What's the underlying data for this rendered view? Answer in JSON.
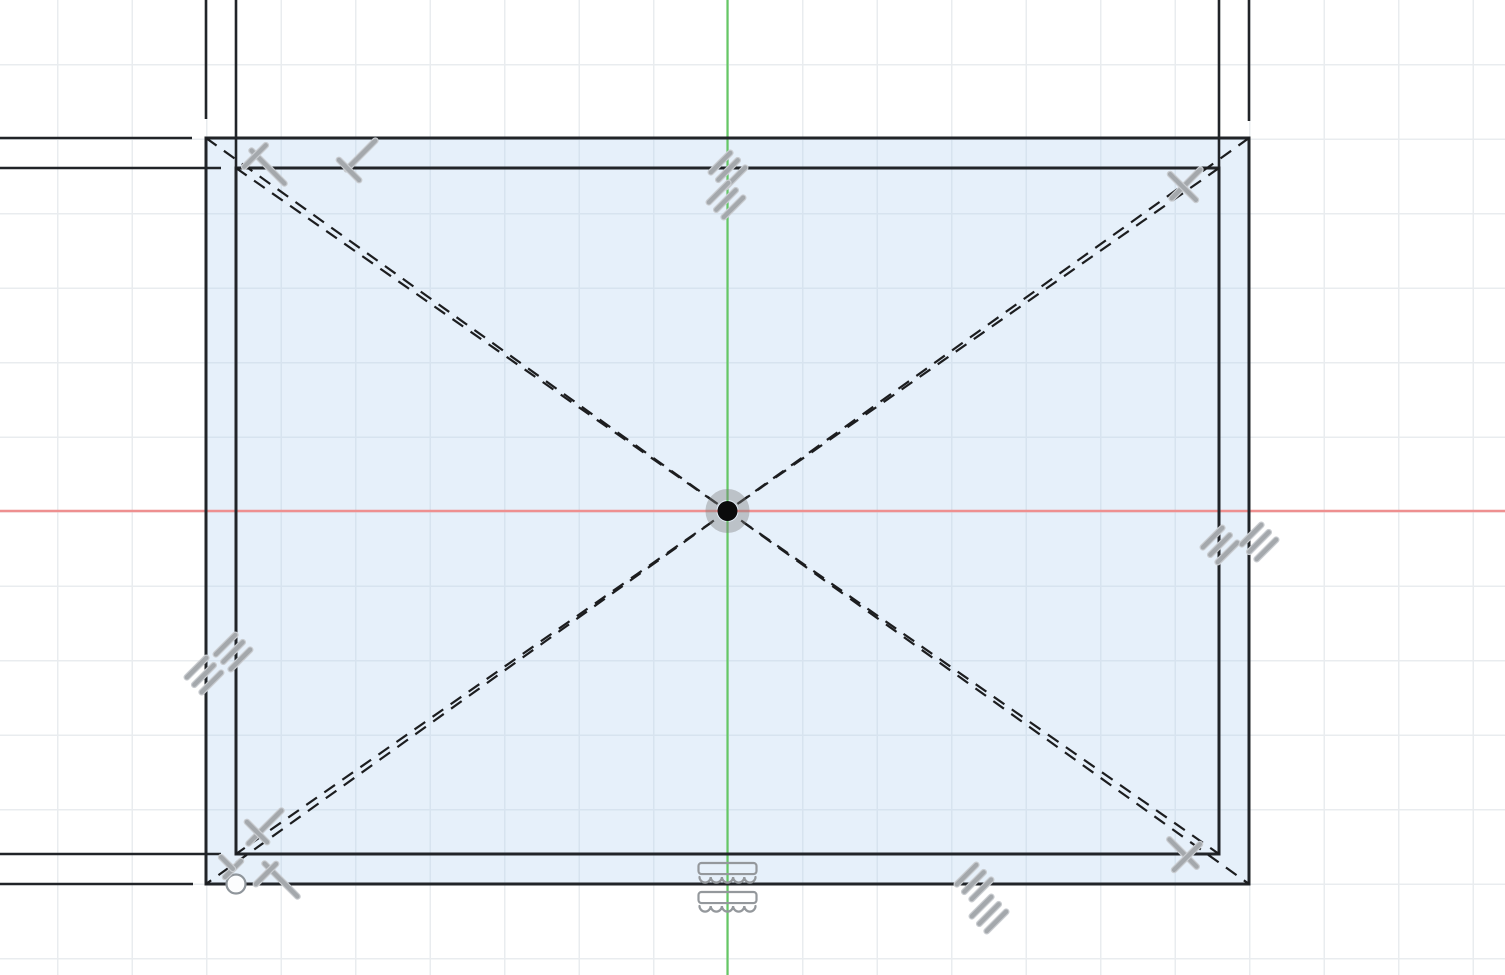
{
  "canvas": {
    "width": 1505,
    "height": 975,
    "background": "#ffffff",
    "grid": {
      "spacing": 74.5,
      "offset_x": 57,
      "offset_y": 64,
      "color": "#e9ecef"
    }
  },
  "style": {
    "wall_line_color": "#212428",
    "wall_line_width": 3,
    "extension_line_width": 2.6,
    "construction_color": "#1c1d1f",
    "construction_dash": "13 9",
    "construction_width": 2.2,
    "axis_green": "#65c765",
    "axis_red": "#ee9090",
    "profile_fill": "rgba(182,212,240,0.35)",
    "glyph_bar_fill": "#a4a8ac",
    "glyph_bar_stroke": "#c9ccd0",
    "glyph_outline_stroke": "#94989c",
    "hatch_bar_length": 33,
    "hatch_bar_width": 5.5,
    "hatch_bar_gap": 10.5,
    "perp_bar_width": 5.5,
    "fix_glyph_width": 58,
    "fix_glyph_height": 24
  },
  "entities": [
    {
      "name": "profile-fill",
      "type": "rect",
      "x": 206,
      "y": 138,
      "w": 1043,
      "h": 746,
      "fill": "rgba(182,212,240,0.35)",
      "stroke": "none",
      "sw": 0,
      "interactable": true
    },
    {
      "name": "y-axis-line",
      "type": "line",
      "x1": 727.5,
      "y1": 0,
      "x2": 727.5,
      "y2": 975,
      "stroke": "#65c765",
      "sw": 2.2,
      "interactable": true
    },
    {
      "name": "x-axis-line",
      "type": "line",
      "x1": 0,
      "y1": 511,
      "x2": 1505,
      "y2": 511,
      "stroke": "#ee9090",
      "sw": 2.4,
      "interactable": true
    },
    {
      "name": "wall-extension-line-top-outer-left",
      "type": "line",
      "x1": 0,
      "y1": 138,
      "x2": 192,
      "y2": 138,
      "stroke": "#212428",
      "sw": 2.6,
      "interactable": true
    },
    {
      "name": "wall-extension-line-top-inner-left",
      "type": "line",
      "x1": 0,
      "y1": 168,
      "x2": 221,
      "y2": 168,
      "stroke": "#212428",
      "sw": 2.6,
      "interactable": true
    },
    {
      "name": "wall-extension-line-bottom-inner-left",
      "type": "line",
      "x1": 0,
      "y1": 854,
      "x2": 221,
      "y2": 854,
      "stroke": "#212428",
      "sw": 2.6,
      "interactable": true
    },
    {
      "name": "wall-extension-line-bottom-outer-left",
      "type": "line",
      "x1": 0,
      "y1": 884,
      "x2": 193,
      "y2": 884,
      "stroke": "#212428",
      "sw": 2.6,
      "interactable": true
    },
    {
      "name": "wall-extension-line-left-outer-top",
      "type": "line",
      "x1": 206,
      "y1": 0,
      "x2": 206,
      "y2": 119,
      "stroke": "#212428",
      "sw": 2.6,
      "interactable": true
    },
    {
      "name": "wall-extension-line-left-inner-top",
      "type": "line",
      "x1": 236,
      "y1": 0,
      "x2": 236,
      "y2": 168,
      "stroke": "#212428",
      "sw": 2.6,
      "interactable": true
    },
    {
      "name": "wall-extension-line-right-inner-top",
      "type": "line",
      "x1": 1219,
      "y1": 0,
      "x2": 1219,
      "y2": 168,
      "stroke": "#212428",
      "sw": 2.6,
      "interactable": true
    },
    {
      "name": "wall-extension-line-right-outer-top",
      "type": "line",
      "x1": 1249,
      "y1": 0,
      "x2": 1249,
      "y2": 121,
      "stroke": "#212428",
      "sw": 2.6,
      "interactable": true
    },
    {
      "name": "outer-wall-rectangle",
      "type": "rect",
      "x": 206,
      "y": 138,
      "w": 1043,
      "h": 746,
      "fill": "none",
      "stroke": "#212428",
      "sw": 3,
      "interactable": true
    },
    {
      "name": "inner-wall-rectangle",
      "type": "rect",
      "x": 236,
      "y": 168,
      "w": 983,
      "h": 686,
      "fill": "none",
      "stroke": "#212428",
      "sw": 3,
      "interactable": true
    },
    {
      "name": "construction-diagonal-outer-tlbr",
      "type": "line",
      "x1": 206,
      "y1": 138,
      "x2": 1249,
      "y2": 884,
      "stroke": "#1c1d1f",
      "sw": 2.2,
      "dash": "13 9",
      "interactable": true
    },
    {
      "name": "construction-diagonal-outer-trbl",
      "type": "line",
      "x1": 1249,
      "y1": 138,
      "x2": 206,
      "y2": 884,
      "stroke": "#1c1d1f",
      "sw": 2.2,
      "dash": "13 9",
      "interactable": true
    },
    {
      "name": "construction-diagonal-inner-tlbr",
      "type": "line",
      "x1": 236,
      "y1": 168,
      "x2": 1219,
      "y2": 854,
      "stroke": "#1c1d1f",
      "sw": 2.2,
      "dash": "13 9",
      "interactable": true
    },
    {
      "name": "construction-diagonal-inner-trbl",
      "type": "line",
      "x1": 1219,
      "y1": 168,
      "x2": 236,
      "y2": 854,
      "stroke": "#1c1d1f",
      "sw": 2.2,
      "dash": "13 9",
      "interactable": true
    },
    {
      "name": "origin-highlight-ring",
      "type": "circle",
      "cx": 727.5,
      "cy": 511,
      "r": 16.5,
      "fill": "none",
      "stroke": "rgba(125,125,125,0.4)",
      "sw": 11,
      "interactable": false
    },
    {
      "name": "origin-point",
      "type": "circle",
      "cx": 727.5,
      "cy": 511,
      "r": 10,
      "fill": "#0b0b0c",
      "stroke": "none",
      "sw": 0,
      "interactable": true
    },
    {
      "name": "sketch-endpoint",
      "type": "circle",
      "cx": 236,
      "cy": 884,
      "r": 9.5,
      "fill": "#fcfdfe",
      "stroke": "#8f959b",
      "sw": 2.2,
      "interactable": true
    },
    {
      "name": "parallel-constraint-icon",
      "type": "hatch",
      "cx": 728,
      "cy": 170,
      "interactable": true
    },
    {
      "name": "parallel-constraint-icon",
      "type": "hatch",
      "cx": 726,
      "cy": 200,
      "interactable": true
    },
    {
      "name": "parallel-constraint-icon",
      "type": "hatch",
      "cx": 1220,
      "cy": 545,
      "interactable": true
    },
    {
      "name": "parallel-constraint-icon",
      "type": "hatch",
      "cx": 1259,
      "cy": 542,
      "interactable": true
    },
    {
      "name": "parallel-constraint-icon",
      "type": "hatch",
      "cx": 204,
      "cy": 675,
      "interactable": true
    },
    {
      "name": "parallel-constraint-icon",
      "type": "hatch",
      "cx": 233,
      "cy": 652,
      "interactable": true
    },
    {
      "name": "parallel-constraint-icon",
      "type": "hatch",
      "cx": 974,
      "cy": 882,
      "interactable": true
    },
    {
      "name": "parallel-constraint-icon",
      "type": "hatch",
      "cx": 989,
      "cy": 914,
      "interactable": true
    },
    {
      "name": "perpendicular-constraint-icon",
      "type": "perp",
      "interactable": true,
      "bars": [
        {
          "cx": 268,
          "cy": 167,
          "rot": 45,
          "len": 52
        },
        {
          "cx": 255,
          "cy": 156,
          "rot": -45,
          "len": 36
        }
      ]
    },
    {
      "name": "perpendicular-constraint-icon",
      "type": "perp",
      "interactable": true,
      "bars": [
        {
          "cx": 361,
          "cy": 155,
          "rot": -45,
          "len": 46
        },
        {
          "cx": 349,
          "cy": 170,
          "rot": 45,
          "len": 34
        }
      ]
    },
    {
      "name": "perpendicular-constraint-icon",
      "type": "perp",
      "interactable": true,
      "bars": [
        {
          "cx": 1186,
          "cy": 184,
          "rot": -45,
          "len": 46
        },
        {
          "cx": 1183,
          "cy": 187,
          "rot": 45,
          "len": 42
        }
      ]
    },
    {
      "name": "perpendicular-constraint-icon",
      "type": "perp",
      "interactable": true,
      "bars": [
        {
          "cx": 1183,
          "cy": 853,
          "rot": 45,
          "len": 44
        },
        {
          "cx": 1187,
          "cy": 857,
          "rot": -45,
          "len": 42
        }
      ]
    },
    {
      "name": "perpendicular-constraint-icon",
      "type": "perp",
      "interactable": true,
      "bars": [
        {
          "cx": 265,
          "cy": 827,
          "rot": -45,
          "len": 52
        },
        {
          "cx": 257,
          "cy": 832,
          "rot": 45,
          "len": 34
        }
      ]
    },
    {
      "name": "perpendicular-constraint-icon",
      "type": "perp",
      "interactable": true,
      "bars": [
        {
          "cx": 281,
          "cy": 880,
          "rot": 45,
          "len": 52
        },
        {
          "cx": 266,
          "cy": 874,
          "rot": -45,
          "len": 34
        }
      ]
    },
    {
      "name": "perpendicular-constraint-icon",
      "type": "perp",
      "interactable": true,
      "bars": [
        {
          "cx": 233,
          "cy": 869,
          "rot": -45,
          "len": 28
        },
        {
          "cx": 227,
          "cy": 863,
          "rot": 45,
          "len": 22
        }
      ]
    },
    {
      "name": "fix-constraint-icon",
      "type": "fix",
      "cx": 727.5,
      "cy": 875,
      "interactable": true
    },
    {
      "name": "fix-constraint-icon",
      "type": "fix",
      "cx": 727.5,
      "cy": 904,
      "interactable": true
    }
  ]
}
